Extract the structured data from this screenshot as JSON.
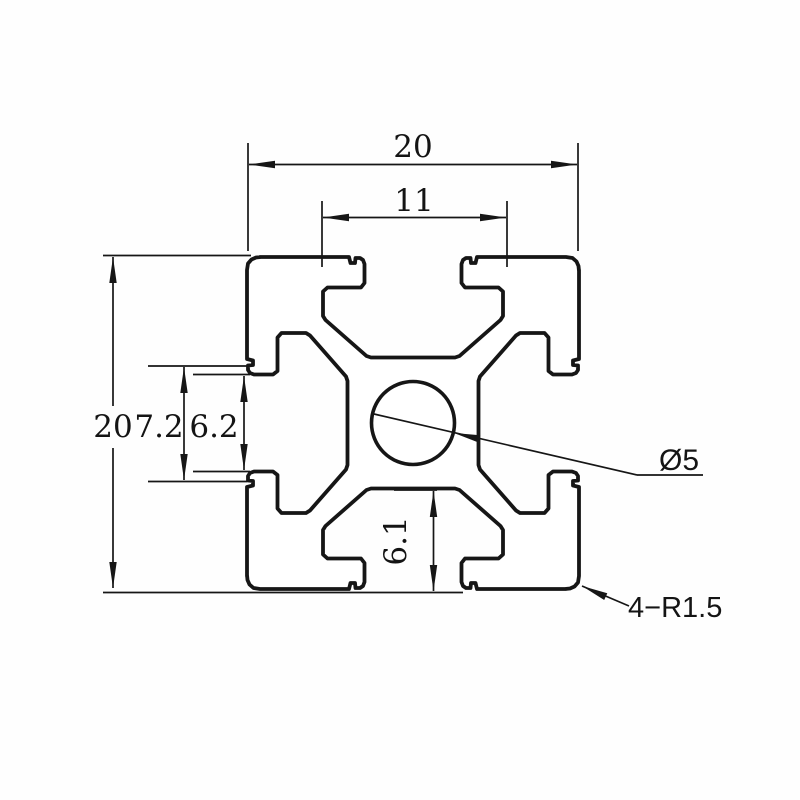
{
  "drawing": {
    "type": "technical-drawing",
    "subject": "2020 aluminum extrusion profile cross-section",
    "background_color": "#fefefe",
    "line_color": "#161616",
    "dimensions": {
      "overall_width": "20",
      "slot_inner_width": "11",
      "overall_height": "20",
      "groove_width": "7.2",
      "slot_opening": "6.2",
      "slot_depth": "6.1",
      "center_hole": "Ø5",
      "corner_radius": "4−R1.5"
    }
  }
}
